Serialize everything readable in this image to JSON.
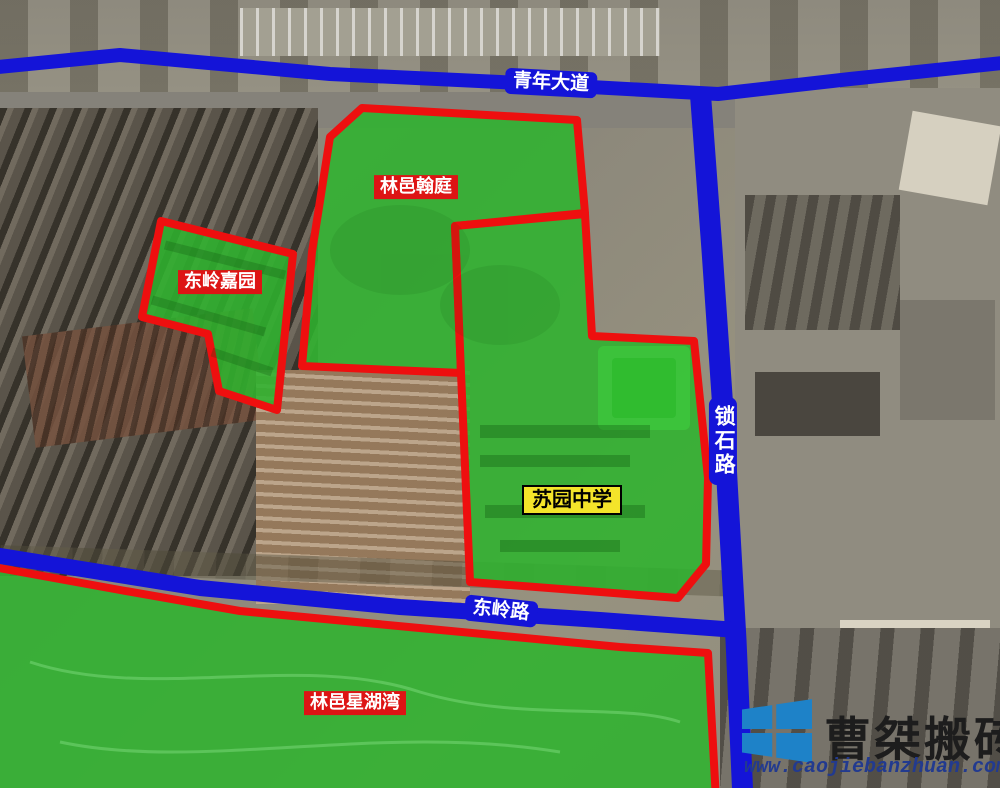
{
  "map": {
    "roads": [
      {
        "id": "qingnian-avenue",
        "name": "青年大道",
        "width": 14,
        "path": [
          [
            -12,
            68
          ],
          [
            120,
            55
          ],
          [
            330,
            74
          ],
          [
            500,
            82
          ],
          [
            718,
            94
          ],
          [
            850,
            79
          ],
          [
            1012,
            62
          ]
        ],
        "label": {
          "x": 551,
          "y": 83,
          "rotate": 3,
          "vertical": false
        }
      },
      {
        "id": "suoshi-road",
        "name": "锁石路",
        "width": 21,
        "path": [
          [
            700,
            88
          ],
          [
            712,
            250
          ],
          [
            723,
            410
          ],
          [
            736,
            640
          ],
          [
            743,
            800
          ]
        ],
        "label": {
          "x": 723,
          "y": 441,
          "rotate": 0,
          "vertical": true
        }
      },
      {
        "id": "dongling-road",
        "name": "东岭路",
        "width": 16,
        "path": [
          [
            -12,
            554
          ],
          [
            200,
            588
          ],
          [
            400,
            607
          ],
          [
            600,
            620
          ],
          [
            737,
            630
          ]
        ],
        "label": {
          "x": 501,
          "y": 611,
          "rotate": 6,
          "vertical": false
        }
      }
    ],
    "regions": [
      {
        "id": "linyi-hanting",
        "name": "林邑翰庭",
        "labelStyle": "red",
        "label": {
          "x": 416,
          "y": 187
        },
        "points": [
          [
            330,
            137
          ],
          [
            362,
            108
          ],
          [
            577,
            120
          ],
          [
            585,
            213
          ],
          [
            455,
            226
          ],
          [
            461,
            373
          ],
          [
            302,
            366
          ],
          [
            312,
            252
          ]
        ]
      },
      {
        "id": "dongling-jiayuan",
        "name": "东岭嘉园",
        "labelStyle": "red",
        "label": {
          "x": 220,
          "y": 282
        },
        "points": [
          [
            161,
            221
          ],
          [
            293,
            254
          ],
          [
            277,
            410
          ],
          [
            219,
            391
          ],
          [
            208,
            334
          ],
          [
            142,
            317
          ]
        ]
      },
      {
        "id": "suyuan-middle-school",
        "name": "苏园中学",
        "labelStyle": "yellow",
        "label": {
          "x": 572,
          "y": 500
        },
        "points": [
          [
            585,
            214
          ],
          [
            455,
            226
          ],
          [
            461,
            373
          ],
          [
            470,
            582
          ],
          [
            678,
            598
          ],
          [
            706,
            564
          ],
          [
            708,
            478
          ],
          [
            694,
            341
          ],
          [
            592,
            336
          ]
        ]
      },
      {
        "id": "linyi-xinghuwan",
        "name": "林邑星湖湾",
        "labelStyle": "red",
        "label": {
          "x": 355,
          "y": 703
        },
        "points": [
          [
            -12,
            566
          ],
          [
            120,
            590
          ],
          [
            240,
            611
          ],
          [
            430,
            629
          ],
          [
            620,
            647
          ],
          [
            708,
            653
          ],
          [
            716,
            800
          ],
          [
            -12,
            800
          ]
        ]
      }
    ]
  },
  "watermark": {
    "brand": "曹桀搬砖",
    "url": "www.caojiebanzhuan.com",
    "logo": "windows-flag-logo"
  },
  "colors": {
    "road_blue": "#1414d8",
    "region_fill_green": "#2eb32e",
    "region_stroke_red": "#ee0f0f",
    "label_red_bg": "#dd1414",
    "label_yellow_bg": "#f4e42a",
    "logo_blue": "#1e82c8",
    "url_blue": "#223a8f"
  }
}
